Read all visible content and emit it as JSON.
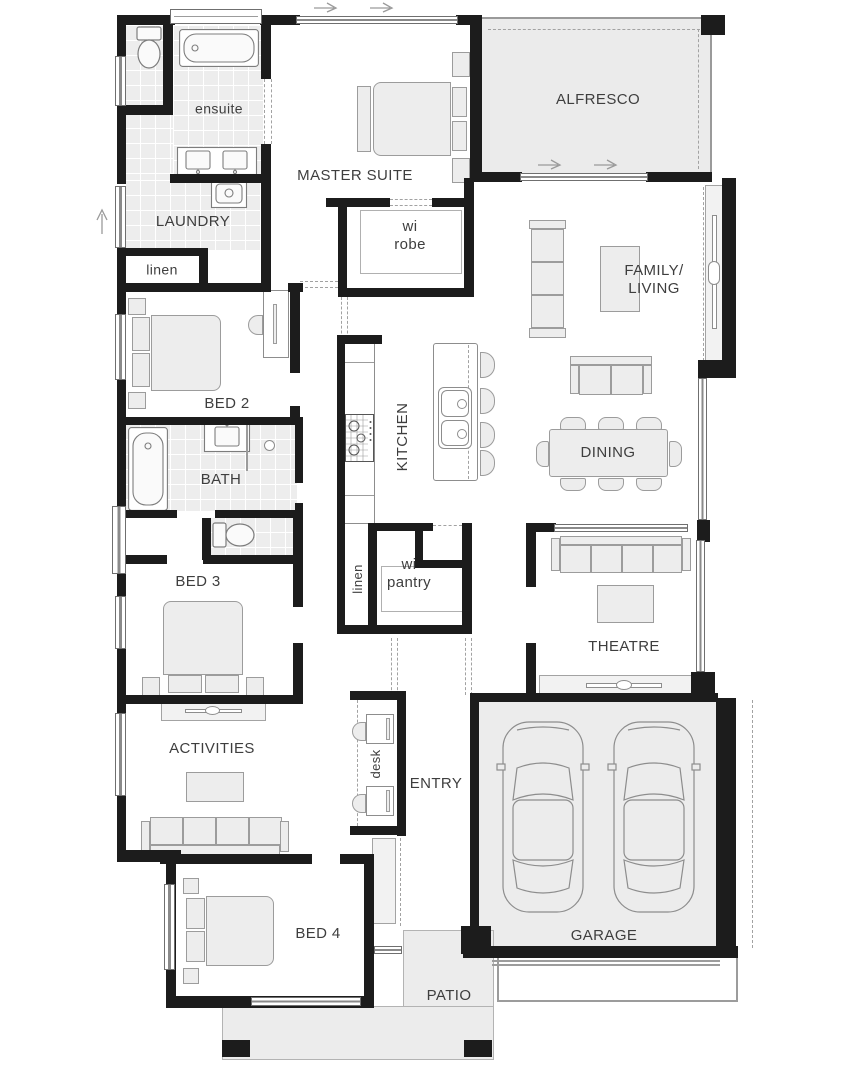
{
  "title": "single-storey home floor plan",
  "colors": {
    "wall": "#1c1c1c",
    "tile_fill": "#ededed",
    "outdoor_fill": "#ebebeb",
    "furniture_fill": "#ededed",
    "furniture_line": "#9c9c9c",
    "label_text": "#3e3e3e",
    "dash_line": "#a2a2a2"
  },
  "icons": [
    "double-bed-icon",
    "pillow-icon",
    "bedside-table-icon",
    "bathtub-icon",
    "vanity-basin-icon",
    "toilet-icon",
    "laundry-trough-icon",
    "cooktop-icon",
    "island-bench-icon",
    "bar-stool-icon",
    "kitchen-sink-icon",
    "sofa-icon",
    "tv-unit-icon",
    "coffee-table-icon",
    "dining-table-icon",
    "dining-chair-icon",
    "desk-icon",
    "office-chair-icon",
    "wardrobe-shelf-icon",
    "car-icon",
    "window-icon",
    "sliding-door-icon",
    "door-swing-arrow-icon",
    "column-icon"
  ],
  "rooms": [
    {
      "id": "ensuite",
      "label": "ensuite"
    },
    {
      "id": "master_suite",
      "label": "MASTER SUITE"
    },
    {
      "id": "alfresco",
      "label": "ALFRESCO"
    },
    {
      "id": "laundry",
      "label": "LAUNDRY"
    },
    {
      "id": "linen_upper",
      "label": "linen"
    },
    {
      "id": "bed2",
      "label": "BED 2"
    },
    {
      "id": "wi_robe",
      "label": "wi robe"
    },
    {
      "id": "family_living",
      "label": "FAMILY/ LIVING"
    },
    {
      "id": "kitchen",
      "label": "KITCHEN"
    },
    {
      "id": "dining",
      "label": "DINING"
    },
    {
      "id": "bath",
      "label": "BATH"
    },
    {
      "id": "bed3",
      "label": "BED 3"
    },
    {
      "id": "linen_lower",
      "label": "linen"
    },
    {
      "id": "wi_pantry",
      "label": "wi pantry"
    },
    {
      "id": "theatre",
      "label": "THEATRE"
    },
    {
      "id": "activities",
      "label": "ACTIVITIES"
    },
    {
      "id": "desk",
      "label": "desk"
    },
    {
      "id": "entry",
      "label": "ENTRY"
    },
    {
      "id": "bed4",
      "label": "BED 4"
    },
    {
      "id": "garage",
      "label": "GARAGE"
    },
    {
      "id": "patio",
      "label": "PATIO"
    }
  ]
}
